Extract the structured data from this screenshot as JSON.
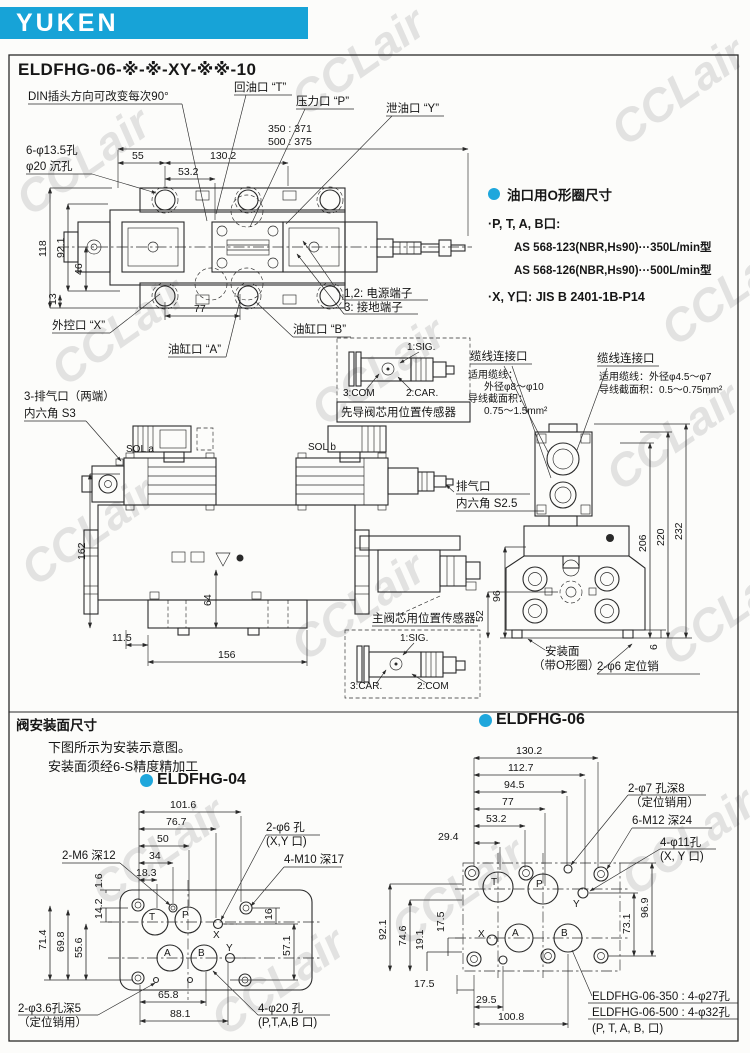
{
  "page": {
    "brand": "YUKEN",
    "watermark": "CCLair",
    "title": "ELDFHG-06-※-※-XY-※※-10",
    "accent_color": "#17a3d7"
  },
  "top": {
    "din_note": "DIN插头方向可改变每次90°",
    "port_t": "回油口 “T”",
    "port_p": "压力口 “P”",
    "port_y": "泄油口 “Y”",
    "len_350": "350 : 371",
    "len_500": "500 : 375",
    "holes_line1": "6-φ13.5孔",
    "holes_line2": "φ20 沉孔",
    "d55": "55",
    "d130_2": "130.2",
    "d53_2": "53.2",
    "d118": "118",
    "d92_1": "92.1",
    "d46": "46",
    "d13": "13",
    "d77": "77",
    "port_x": "外控口 “X”",
    "port_a": "油缸口 “A”",
    "port_b": "油缸口 “B”",
    "terminal_power": "1,2: 电源端子",
    "terminal_ground": "3: 接地端子"
  },
  "oring": {
    "title": "油口用O形圈尺寸",
    "item1": "·P, T, A, B口:",
    "item1_a": "AS 568-123(NBR,Hs90)···350L/min型",
    "item1_b": "AS 568-126(NBR,Hs90)···500L/min型",
    "item2": "·X, Y口: JIS B 2401-1B-P14"
  },
  "front": {
    "bleed_line1": "3-排气口（两端）",
    "bleed_line2": "内六角 S3",
    "sol_a": "SOL a",
    "sol_b": "SOL b",
    "pilot_sensor": {
      "sig": "1:SIG.",
      "com": "3:COM",
      "car": "2:CAR.",
      "caption": "先导阀芯用位置传感器"
    },
    "cable_left": {
      "title": "缆线连接口",
      "l1": "适用缆线：",
      "l2": "外径φ8～φ10",
      "l3": "导线截面积：",
      "l4": "0.75～1.5mm²"
    },
    "cable_right": {
      "title": "缆线连接口",
      "l1": "适用缆线：外径φ4.5～φ7",
      "l2": "导线截面积：0.5～0.75mm²"
    },
    "air_line1": "排气口",
    "air_line2": "内六角 S2.5",
    "main_sensor": {
      "caption": "主阀芯用位置传感器",
      "sig": "1:SIG.",
      "car": "3:CAR.",
      "com": "2:COM"
    },
    "d162": "162",
    "d64": "64",
    "d11_5": "11.5",
    "d156": "156",
    "d206": "206",
    "d220": "220",
    "d232": "232",
    "d96": "96",
    "d52": "52",
    "d6": "6",
    "mount_line1": "安装面",
    "mount_line2": "（带O形圈）",
    "pin": "2-φ6 定位销"
  },
  "mounting": {
    "heading": "阀安装面尺寸",
    "note1": "下图所示为安装示意图。",
    "note2": "安装面须经6-S精度精加工",
    "m04": {
      "title": "ELDFHG-04",
      "d101_6": "101.6",
      "d76_7": "76.7",
      "d50": "50",
      "d34": "34",
      "d18_3": "18.3",
      "m6": "2-M6 深12",
      "xy_hole": "2-φ6 孔",
      "xy_port": "(X,Y 口)",
      "m10": "4-M10 深17",
      "d1_6": "1.6",
      "d14_2": "14.2",
      "d55_6": "55.6",
      "d69_8": "69.8",
      "d71_4": "71.4",
      "d16": "16",
      "d57_1": "57.1",
      "d65_8": "65.8",
      "d88_1": "88.1",
      "pin_line1": "2-φ3.6孔深5",
      "pin_line2": "（定位销用）",
      "ptab_line1": "4-φ20 孔",
      "ptab_line2": "(P,T,A,B 口)",
      "pt": "T",
      "pp": "P",
      "pa": "A",
      "pb": "B",
      "px": "X",
      "py": "Y"
    },
    "m06": {
      "title": "ELDFHG-06",
      "d130_2": "130.2",
      "d112_7": "112.7",
      "d94_5": "94.5",
      "d77": "77",
      "d53_2": "53.2",
      "d29_4": "29.4",
      "pin_line1": "2-φ7 孔深8",
      "pin_line2": "（定位销用）",
      "m12": "6-M12 深24",
      "xy_line1": "4-φ11孔",
      "xy_line2": "(X, Y 口)",
      "d92_1": "92.1",
      "d74_6": "74.6",
      "d17_5a": "17.5",
      "d19_1": "19.1",
      "d73_1": "73.1",
      "d96_9": "96.9",
      "d17_5b": "17.5",
      "d29_5": "29.5",
      "d100_8": "100.8",
      "note350": "ELDFHG-06-350 : 4-φ27孔",
      "note500": "ELDFHG-06-500 : 4-φ32孔",
      "note_ports": "(P, T, A, B, 口)",
      "pt": "T",
      "pp": "P",
      "pa": "A",
      "pb": "B",
      "px": "X",
      "py": "Y"
    }
  }
}
